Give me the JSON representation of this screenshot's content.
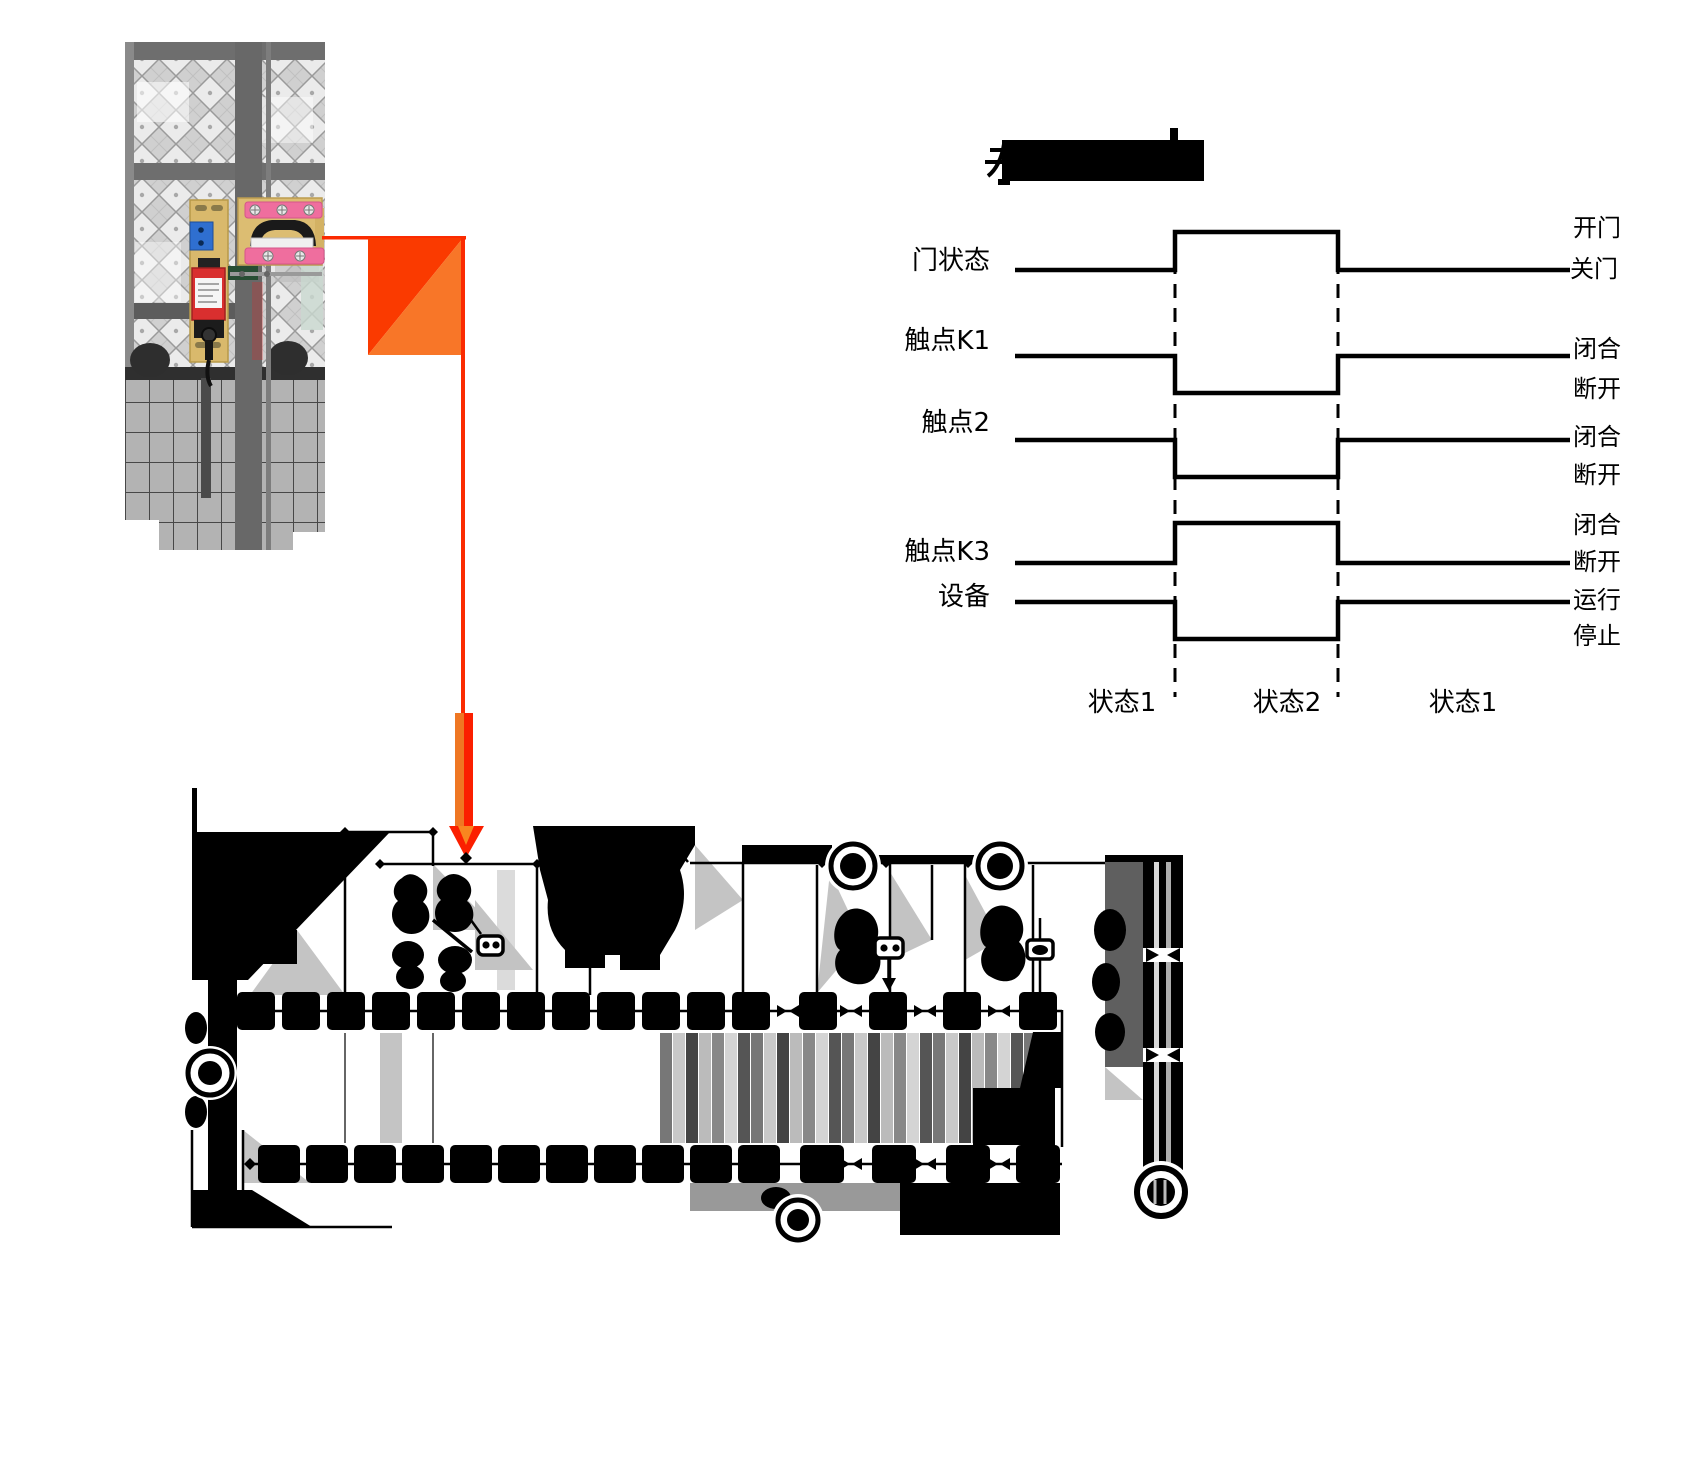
{
  "page": {
    "width": 1685,
    "height": 1476,
    "background": "#ffffff"
  },
  "photo": {
    "description_colors": {
      "fence_gray": "#d0d0d0",
      "frame_gray": "#6e6e6e",
      "bracket_tan": "#d9b96c",
      "bar_pink": "#ef6e9e",
      "block_blue": "#2f6fd0",
      "switch_red": "#d92f2f"
    }
  },
  "callout": {
    "line_red": "#fb2b01",
    "square_upper_left": "#fa3a00",
    "square_lower_right": "#f87628",
    "arrow_orange": "#ef7723"
  },
  "title_box": {
    "redacted": true,
    "color": "#000000"
  },
  "timing_diagram": {
    "rows": [
      {
        "label": "门状态",
        "level_labels": [
          "开门",
          "关门"
        ],
        "baseline": "low",
        "during_state2": "high"
      },
      {
        "label": "触点K1",
        "level_labels": [
          "闭合",
          "断开"
        ],
        "baseline": "high",
        "during_state2": "low"
      },
      {
        "label": "触点2",
        "level_labels": [
          "闭合",
          "断开"
        ],
        "baseline": "high",
        "during_state2": "low"
      },
      {
        "label": "触点K3",
        "level_labels": [
          "闭合",
          "断开"
        ],
        "baseline": "low",
        "during_state2": "high"
      },
      {
        "label": "设备",
        "level_labels": [
          "运行",
          "停止"
        ],
        "baseline": "high",
        "during_state2": "low"
      }
    ],
    "state_labels": [
      "状态1",
      "状态2",
      "状态1"
    ],
    "line_color": "#000000"
  }
}
